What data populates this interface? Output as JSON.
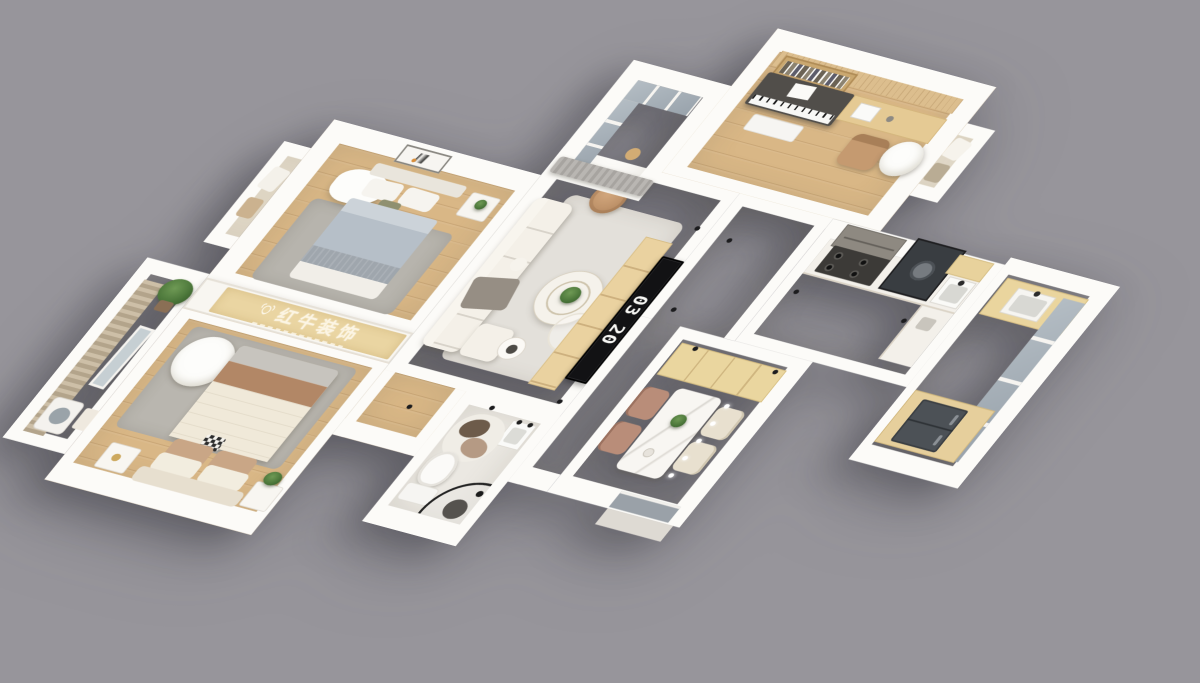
{
  "scene": {
    "description": "3D isometric render of an apartment floor plan on a gray background",
    "background_color": "#97959b"
  },
  "banner": {
    "text": "红牛装饰",
    "panel_color": "#ead5a2",
    "text_color": "#fcf5e4"
  },
  "tv_clock": {
    "top_digits": "03",
    "bottom_digits": "20"
  },
  "palette": {
    "wall": "#fcfbf8",
    "wood_floor": "#d9b786",
    "tile_floor": "#e9e6e1",
    "balcony_floor": "#e8e0d2",
    "bathroom_floor": "#ebe8e2",
    "rug_gray": "#b9b6af",
    "rug_light": "#e3e0da",
    "sofa_cream": "#f4f0e8",
    "bed_cream": "#efe8d8",
    "bed_blue_gray": "#b6bfc8",
    "accent_brown": "#b48a69",
    "wood_cabinet": "#ead59e",
    "glass": "#a9b2ba",
    "curtain_gray": "#b7b4b0",
    "plant_green": "#4a7539",
    "piano_dark": "#514e4a",
    "fridge_dark": "#4c5156",
    "tv_black": "#121214",
    "door_gray": "#9aa1a8"
  }
}
